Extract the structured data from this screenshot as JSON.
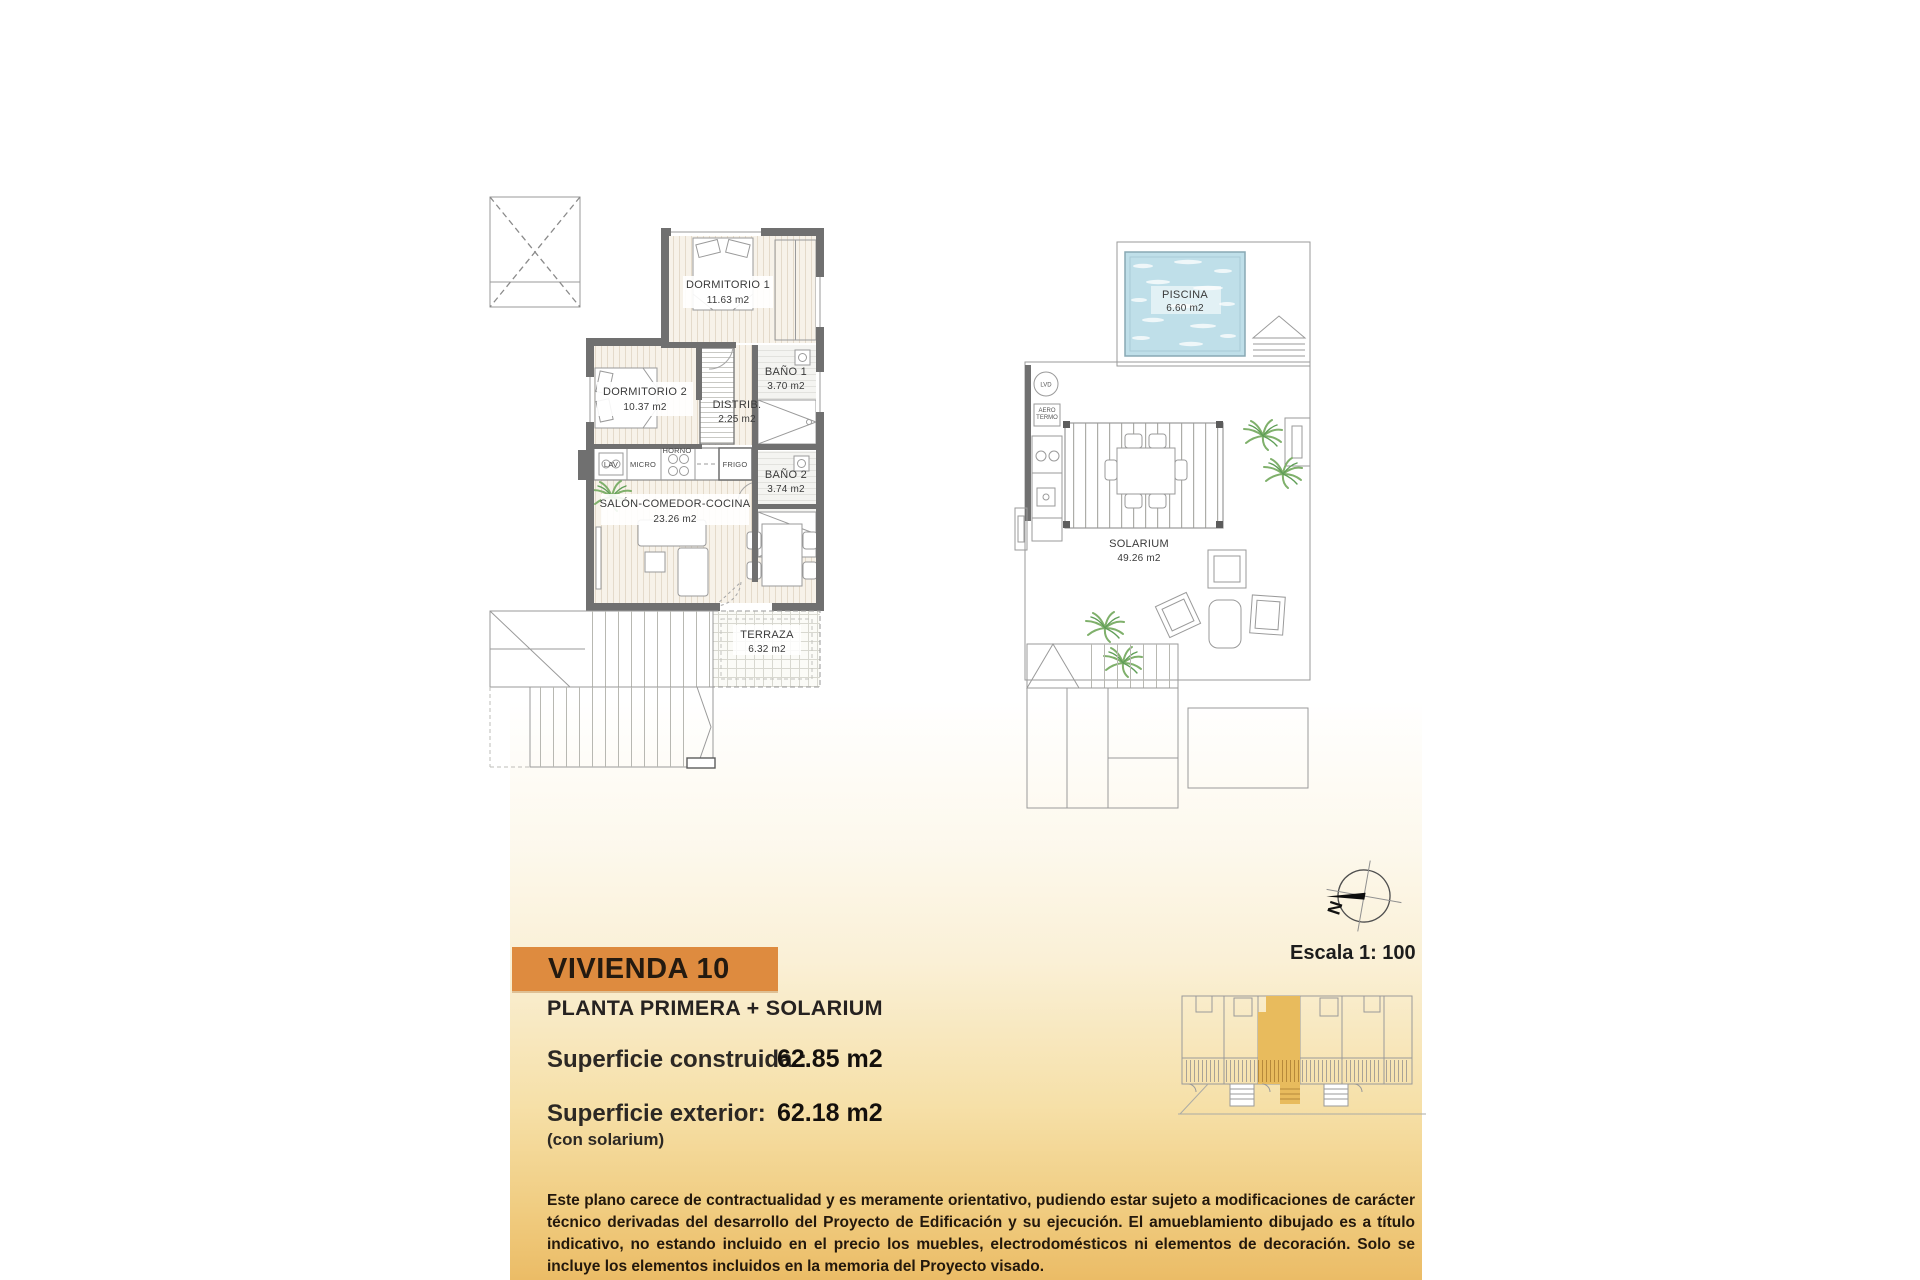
{
  "plan1": {
    "rooms": [
      {
        "name": "DORMITORIO 1",
        "area": "11.63 m2"
      },
      {
        "name": "BAÑO 1",
        "area": "3.70 m2"
      },
      {
        "name": "DISTRIB.",
        "area": "2.25 m2"
      },
      {
        "name": "DORMITORIO 2",
        "area": "10.37 m2"
      },
      {
        "name": "BAÑO 2",
        "area": "3.74 m2"
      },
      {
        "name": "SALÓN-COMEDOR-COCINA",
        "area": "23.26 m2"
      },
      {
        "name": "TERRAZA",
        "area": "6.32 m2"
      }
    ],
    "appliances": {
      "lav": "LAV",
      "micro": "MICRO",
      "horno": "HORNO",
      "frigo": "FRIGO"
    }
  },
  "plan2": {
    "rooms": [
      {
        "name": "PISCINA",
        "area": "6.60 m2"
      },
      {
        "name": "SOLARIUM",
        "area": "49.26 m2"
      }
    ],
    "equipment": {
      "lvd": "LVD",
      "aero": "AERO",
      "termo": "TERMO"
    }
  },
  "compass": {
    "north_letter": "N"
  },
  "scale": {
    "label": "Escala 1: 100"
  },
  "info": {
    "title": "VIVIENDA 10",
    "subtitle": "PLANTA PRIMERA + SOLARIUM",
    "built_label": "Superficie construida :",
    "built_value": "62.85 m2",
    "exterior_label": "Superficie exterior:",
    "exterior_value": "62.18 m2",
    "exterior_note": "(con solarium)",
    "disclaimer": "Este plano carece de contractualidad y es meramente orientativo, pudiendo estar sujeto a modificaciones de carácter técnico derivadas del desarrollo del Proyecto de Edificación y su ejecución. El amueblamiento dibujado es a título indicativo, no estando incluido en el precio los muebles, electrodomésticos ni elementos de decoración. Solo se incluye los elementos incluidos en la memoria del Proyecto visado."
  },
  "colors": {
    "accent_orange": "#DE8B3F",
    "keyplan_highlight": "#E8BB5D",
    "pool_water": "#BFDFE9",
    "wall_gray": "#707070",
    "gradient_gold": "#EBBC66"
  }
}
